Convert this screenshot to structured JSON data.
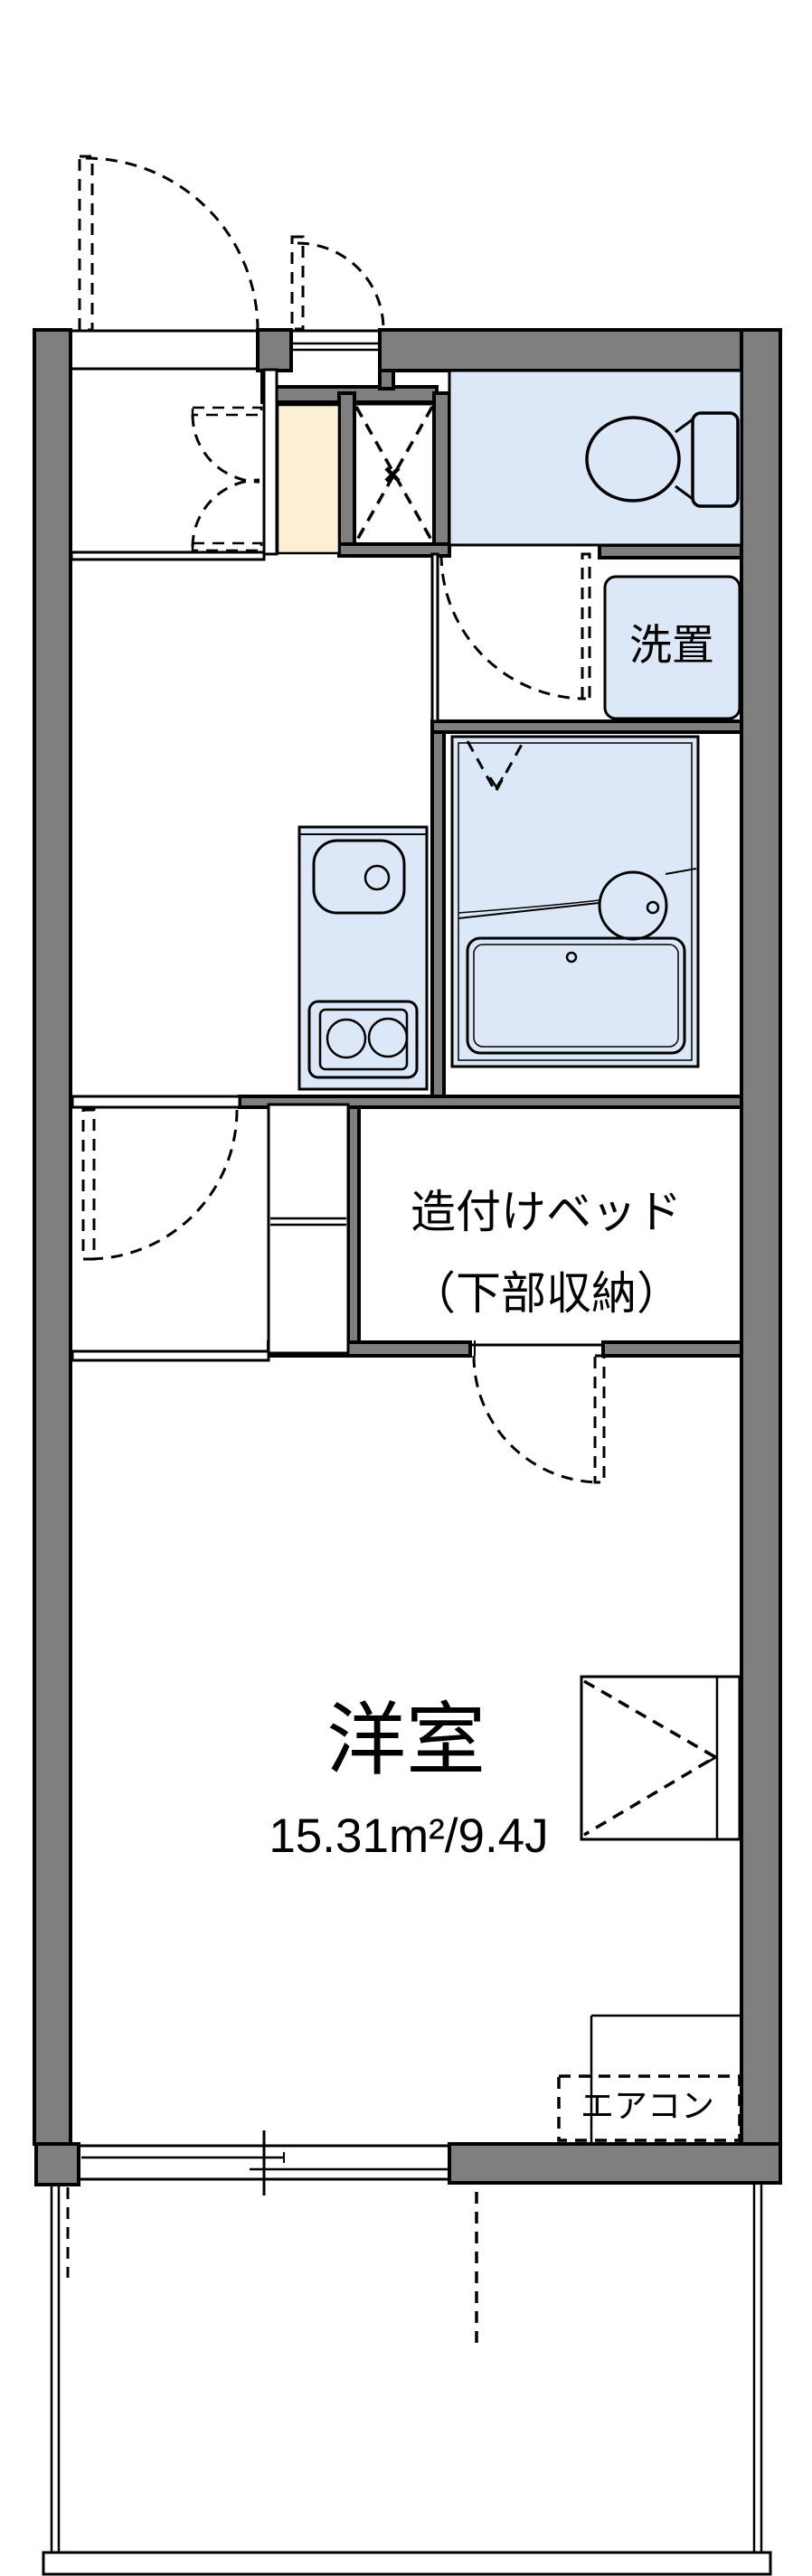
{
  "title": "apartment floor plan",
  "colors": {
    "wall": "#7f7f7f",
    "fixture": "#dce8f8",
    "genkan": "#fbefd5",
    "line": "#000000"
  },
  "rooms": {
    "western_room": {
      "name": "洋室",
      "area": "15.31m²/9.4J"
    },
    "built_in_bed": {
      "line1": "造付けベッド",
      "line2": "（下部収納）"
    },
    "washer_place": {
      "label": "洗置"
    },
    "air_conditioner": {
      "label": "エアコン"
    }
  }
}
